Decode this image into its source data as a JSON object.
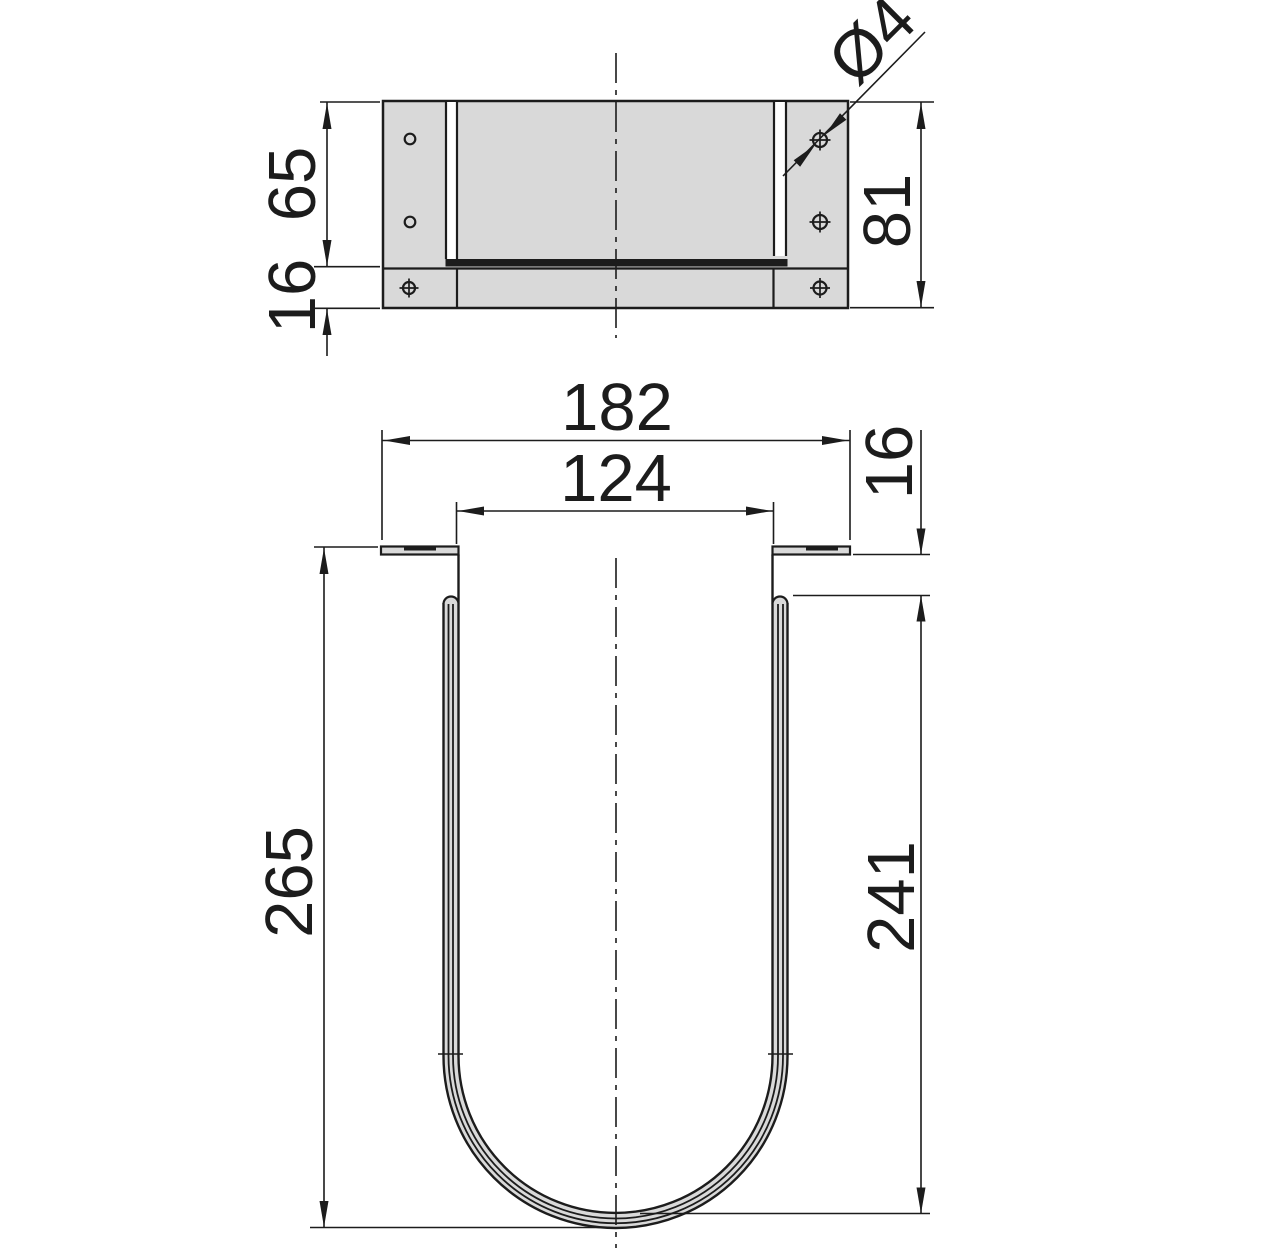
{
  "colors": {
    "line": "#1c1c1c",
    "part_fill": "#d9d9d9",
    "background": "#ffffff"
  },
  "plan_view": {
    "dim_depth_body": "65",
    "dim_depth_back_flange": "16",
    "dim_depth_total": "81",
    "dim_hole_diameter": "Ø4"
  },
  "front_view": {
    "dim_width_overall": "182",
    "dim_width_inner": "124",
    "dim_flange_offset": "16",
    "dim_depth_inner": "241",
    "dim_height_overall": "265"
  }
}
